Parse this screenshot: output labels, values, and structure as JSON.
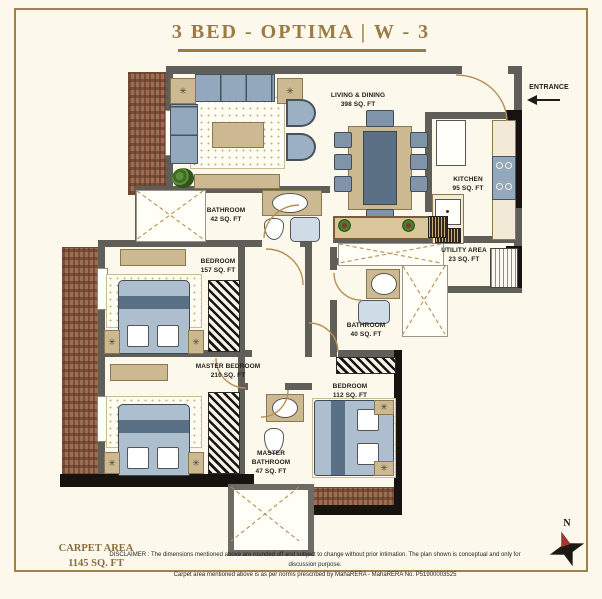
{
  "header": {
    "title": "3 BED - OPTIMA  |  W - 3"
  },
  "plan": {
    "entrance_label": "ENTRANCE",
    "rooms": {
      "living_dining": {
        "name": "LIVING & DINING",
        "area": "398 SQ. FT"
      },
      "kitchen": {
        "name": "KITCHEN",
        "area": "95 SQ. FT"
      },
      "bathroom_common": {
        "name": "BATHROOM",
        "area": "42 SQ. FT"
      },
      "bedroom_2": {
        "name": "BEDROOM",
        "area": "157 SQ. FT"
      },
      "utility": {
        "name": "UTILITY AREA",
        "area": "23 SQ. FT"
      },
      "bathroom_2": {
        "name": "BATHROOM",
        "area": "40 SQ. FT"
      },
      "master_bedroom": {
        "name": "MASTER BEDROOM",
        "area": "210 SQ. FT"
      },
      "bedroom_3": {
        "name": "BEDROOM",
        "area": "112 SQ. FT"
      },
      "master_bathroom": {
        "name": "MASTER BATHROOM",
        "area": "47 SQ. FT"
      }
    },
    "compass": {
      "north_label": "N"
    }
  },
  "footer": {
    "carpet_area_title": "CARPET AREA",
    "carpet_area_value": "1145 SQ. FT",
    "disclaimer_line1": "DISCLAIMER : The dimensions mentioned above are rounded off and subject to change without prior intimation.  The plan shown is conceptual and only for discussion purpose.",
    "disclaimer_line2": "Carpet area mentioned above is as per norms prescribed by MahaRERA - MahaRERA No. P51900003525"
  },
  "colors": {
    "accent_gold": "#9c7a45",
    "wall_gray": "#605e58",
    "wall_black": "#17130e",
    "deck_brown": "#97704f",
    "furniture_blue": "#93a8bd",
    "furniture_tan": "#cdb991",
    "door_arc_tan": "#b78f56",
    "background_cream": "#fcf9ec"
  }
}
